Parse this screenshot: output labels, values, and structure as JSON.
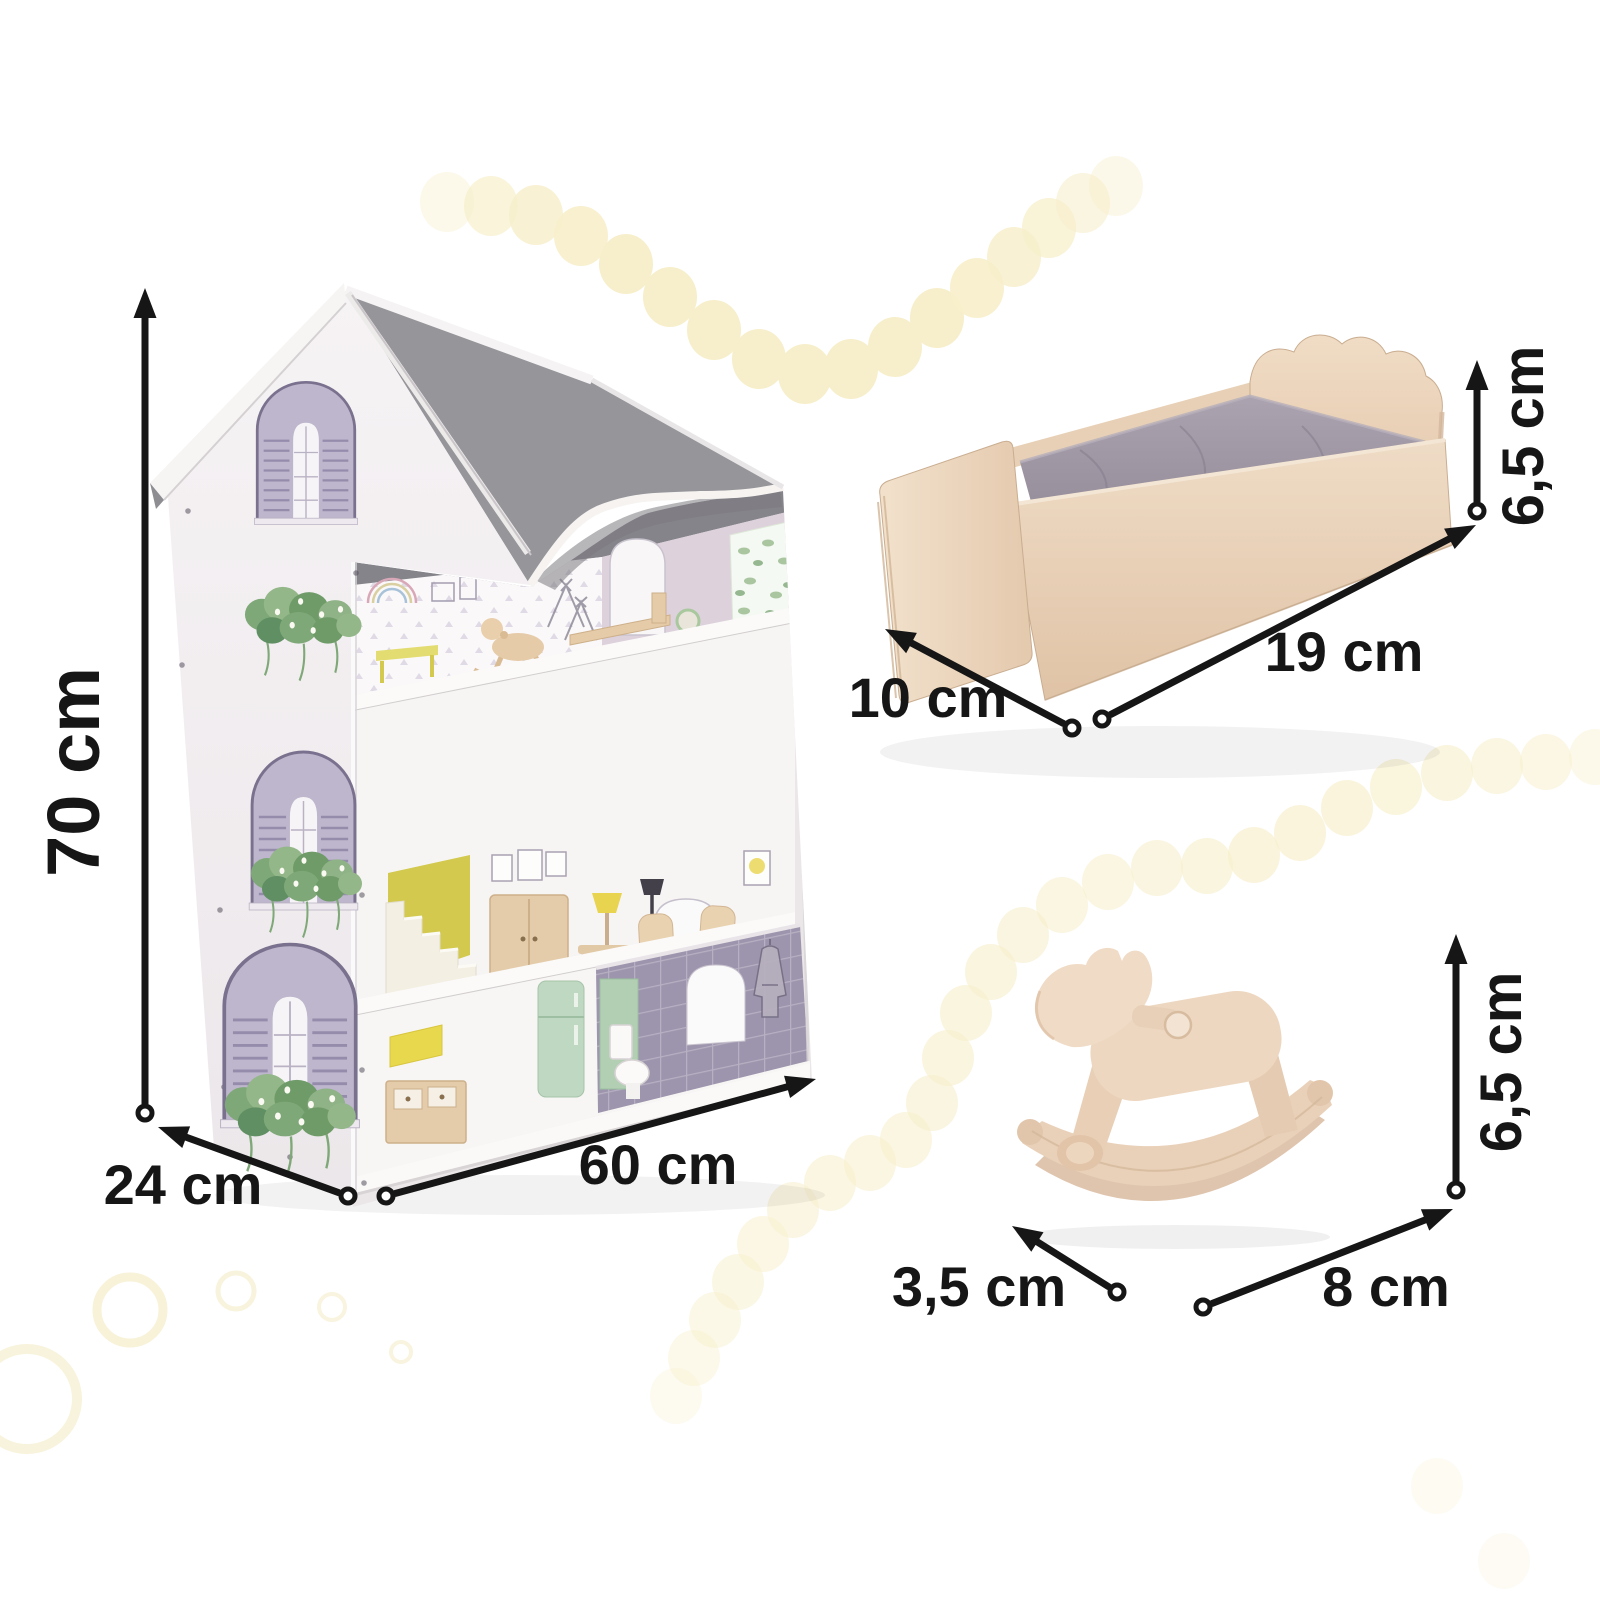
{
  "dimensions": {
    "house_height": "70 cm",
    "house_depth": "24 cm",
    "house_width": "60 cm",
    "bed_height": "6,5 cm",
    "bed_length": "19 cm",
    "bed_depth": "10 cm",
    "horse_height": "6,5 cm",
    "horse_length": "8 cm",
    "horse_depth": "3,5 cm"
  },
  "colors": {
    "background": "#FFFFFF",
    "ink": "#161616",
    "dot": "#F7EFCB",
    "ring": "#F3E9C0",
    "wood_light": "#EFDCC6",
    "mattress_grey": "#9C93A0",
    "roof_grey": "#96959A"
  },
  "annotations": {
    "arrows": [
      {
        "name": "house-height-arrow",
        "from": [
          145,
          1113
        ],
        "to": [
          145,
          288
        ]
      },
      {
        "name": "house-depth-arrow",
        "from": [
          348,
          1196
        ],
        "to": [
          158,
          1127
        ]
      },
      {
        "name": "house-width-arrow",
        "from": [
          386,
          1196
        ],
        "to": [
          816,
          1079
        ]
      },
      {
        "name": "bed-height-arrow",
        "from": [
          1477,
          511
        ],
        "to": [
          1477,
          360
        ]
      },
      {
        "name": "bed-length-arrow",
        "from": [
          1102,
          719
        ],
        "to": [
          1476,
          525
        ]
      },
      {
        "name": "bed-depth-arrow",
        "from": [
          1072,
          728
        ],
        "to": [
          885,
          629
        ]
      },
      {
        "name": "horse-height-arrow",
        "from": [
          1456,
          1190
        ],
        "to": [
          1456,
          934
        ]
      },
      {
        "name": "horse-length-arrow",
        "from": [
          1203,
          1307
        ],
        "to": [
          1453,
          1209
        ]
      },
      {
        "name": "horse-depth-arrow",
        "from": [
          1117,
          1292
        ],
        "to": [
          1012,
          1226
        ]
      }
    ]
  },
  "decor": {
    "garland_top": {
      "rx": 27,
      "ry": 30,
      "dots": [
        [
          447,
          202,
          0.4
        ],
        [
          491,
          206,
          0.7
        ],
        [
          536,
          215,
          0.85
        ],
        [
          581,
          236,
          0.92
        ],
        [
          626,
          264,
          1
        ],
        [
          670,
          297,
          1
        ],
        [
          714,
          330,
          1
        ],
        [
          759,
          359,
          1
        ],
        [
          805,
          374,
          1
        ],
        [
          851,
          369,
          1
        ],
        [
          895,
          347,
          1
        ],
        [
          937,
          318,
          1
        ],
        [
          977,
          288,
          0.92
        ],
        [
          1014,
          257,
          0.85
        ],
        [
          1049,
          228,
          0.75
        ],
        [
          1083,
          203,
          0.6
        ],
        [
          1116,
          186,
          0.42
        ]
      ]
    },
    "garland_side": {
      "rx": 26,
      "ry": 28,
      "dots": [
        [
          1595,
          757,
          0.4
        ],
        [
          1546,
          762,
          0.52
        ],
        [
          1497,
          766,
          0.58
        ],
        [
          1447,
          773,
          0.62
        ],
        [
          1396,
          787,
          0.65
        ],
        [
          1347,
          808,
          0.66
        ],
        [
          1300,
          833,
          0.66
        ],
        [
          1254,
          855,
          0.66
        ],
        [
          1207,
          866,
          0.64
        ],
        [
          1157,
          868,
          0.6
        ],
        [
          1108,
          882,
          0.58
        ],
        [
          1062,
          905,
          0.58
        ],
        [
          1023,
          935,
          0.6
        ],
        [
          991,
          972,
          0.62
        ],
        [
          966,
          1013,
          0.62
        ],
        [
          948,
          1058,
          0.62
        ],
        [
          932,
          1103,
          0.6
        ],
        [
          906,
          1140,
          0.58
        ],
        [
          870,
          1163,
          0.56
        ],
        [
          830,
          1183,
          0.55
        ],
        [
          793,
          1210,
          0.54
        ],
        [
          763,
          1244,
          0.52
        ],
        [
          738,
          1282,
          0.5
        ],
        [
          715,
          1320,
          0.46
        ],
        [
          694,
          1358,
          0.4
        ],
        [
          676,
          1396,
          0.3
        ]
      ]
    },
    "extra_dots": {
      "rx": 26,
      "ry": 28,
      "dots": [
        [
          1437,
          1486,
          0.26
        ],
        [
          1504,
          1561,
          0.22
        ]
      ]
    },
    "rings": [
      [
        27,
        1399,
        50,
        10,
        0.55
      ],
      [
        130,
        1310,
        33,
        9,
        0.6
      ],
      [
        236,
        1291,
        18,
        5,
        0.55
      ],
      [
        332,
        1307,
        13,
        4,
        0.5
      ],
      [
        401,
        1352,
        10,
        4,
        0.5
      ]
    ]
  }
}
